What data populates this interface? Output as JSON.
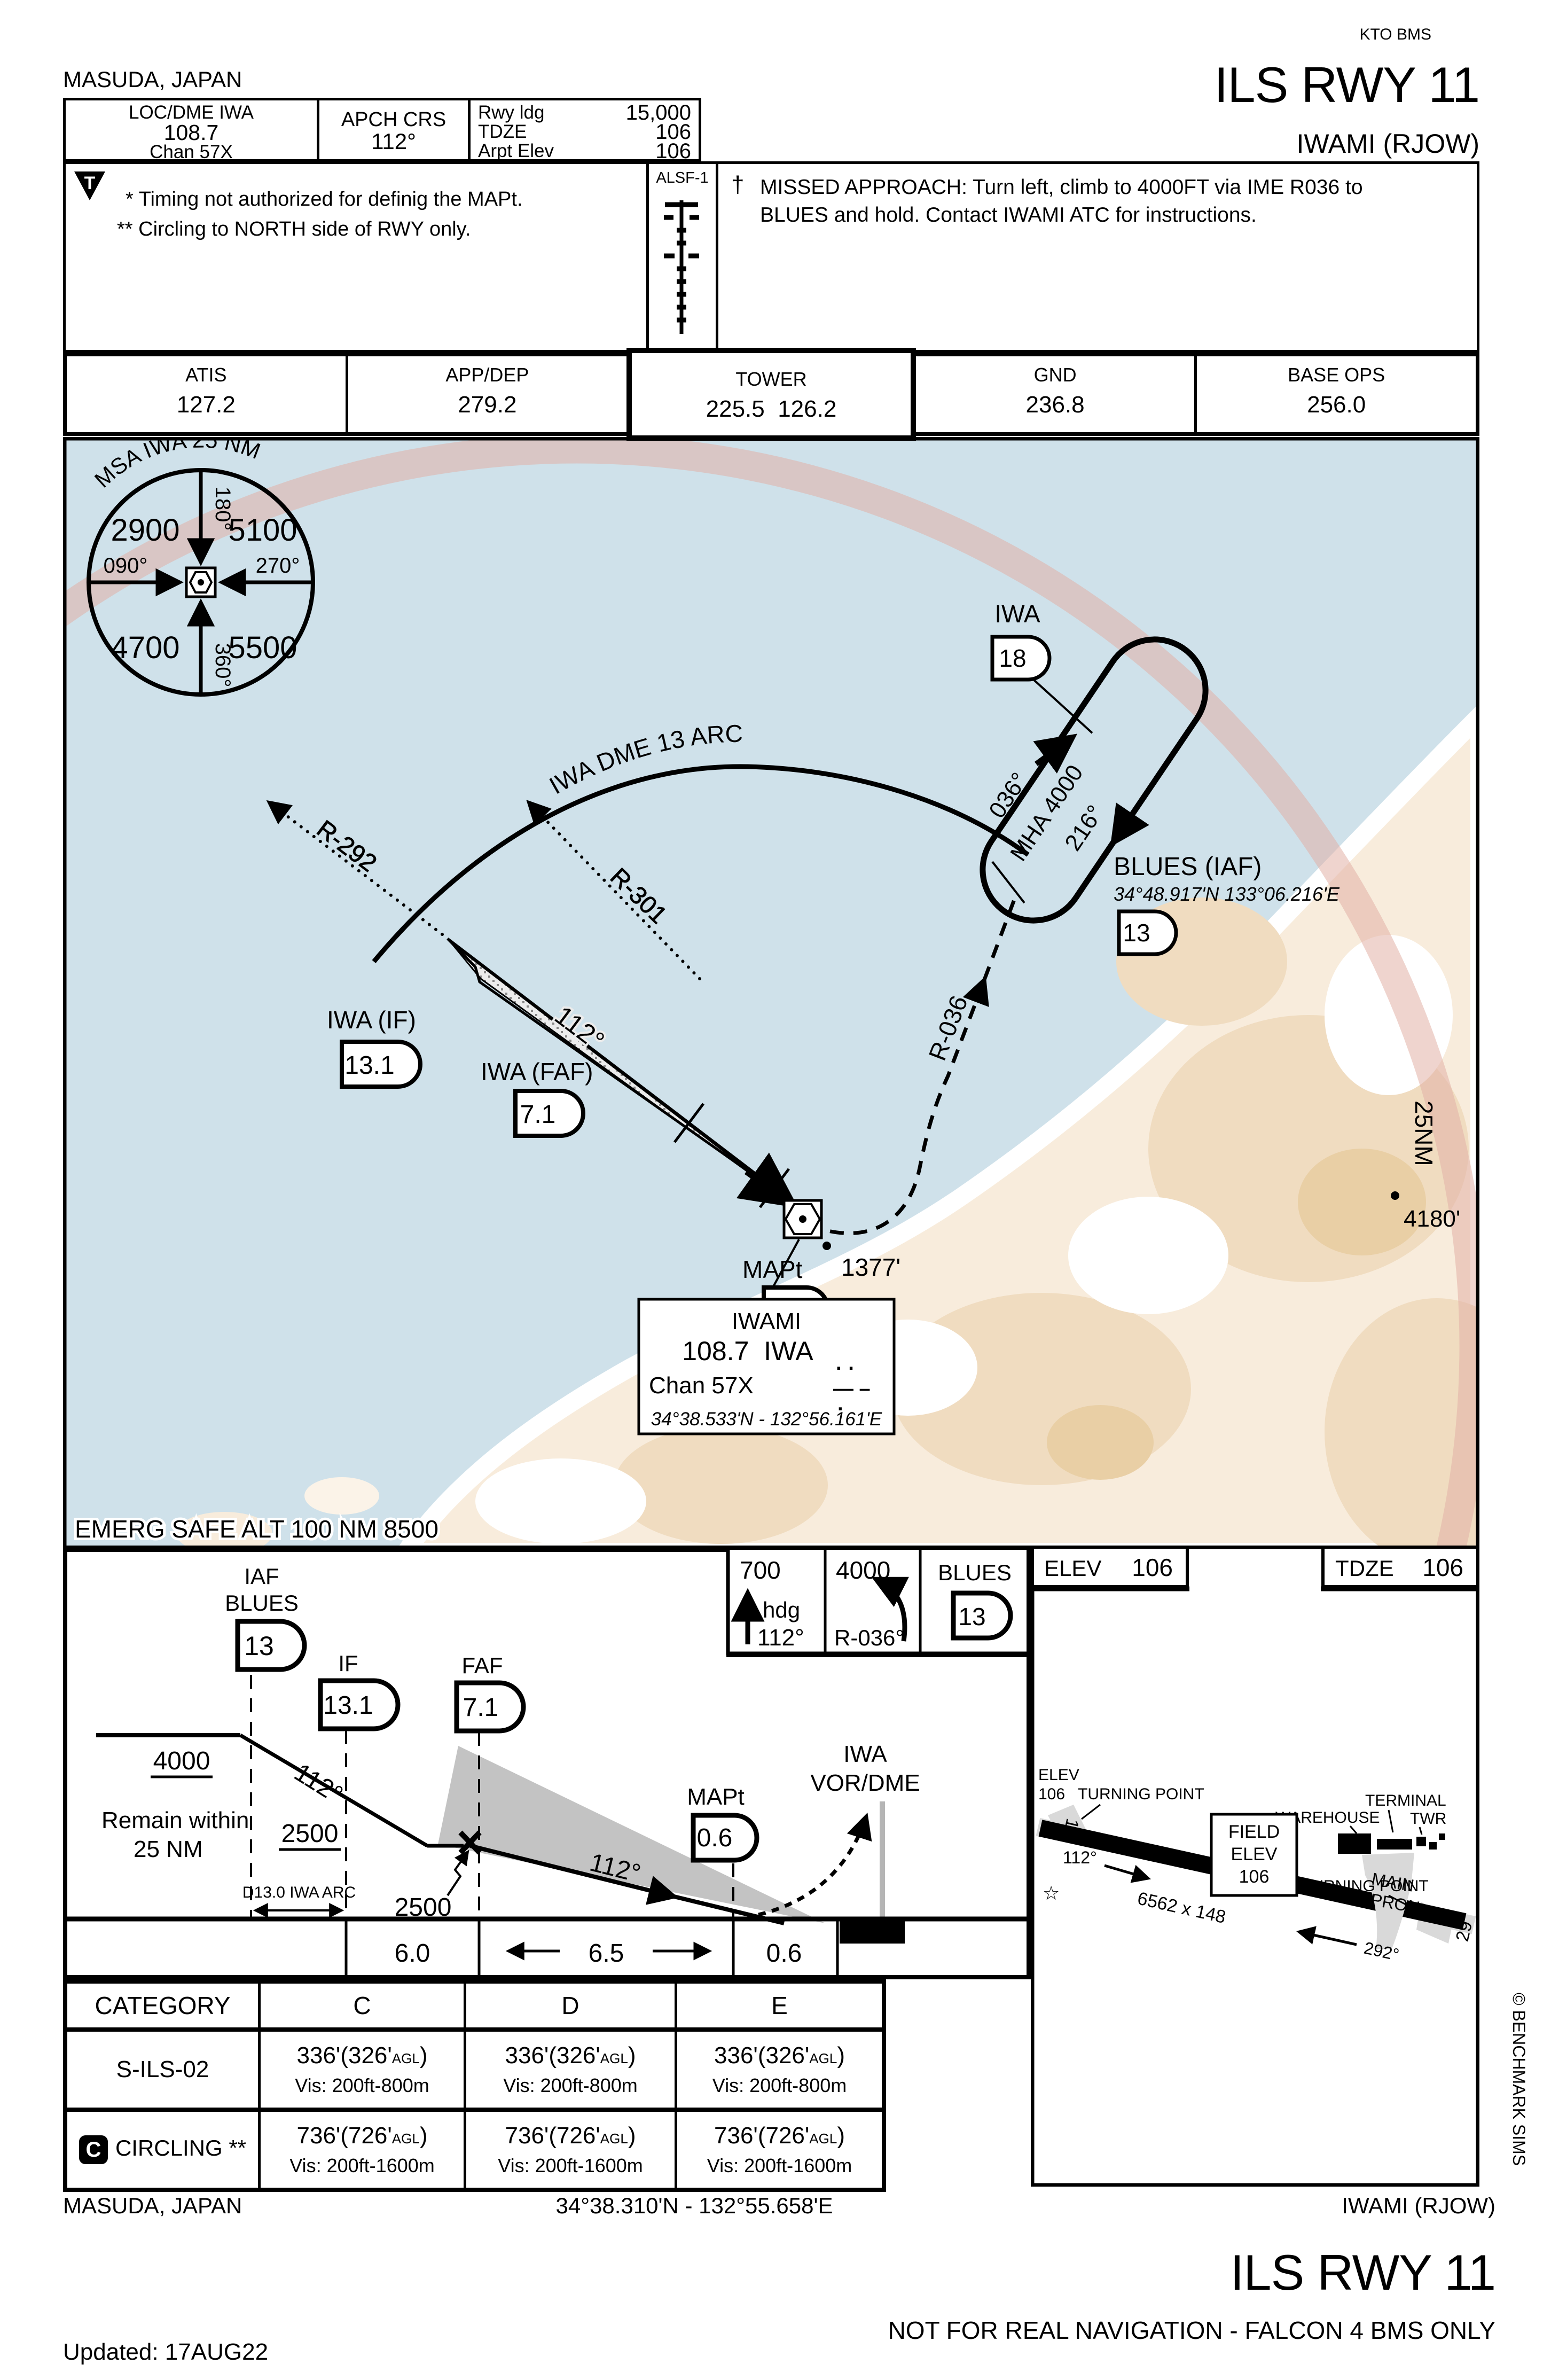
{
  "header": {
    "publisher": "KTO BMS",
    "city": "MASUDA, JAPAN",
    "procedure": "ILS RWY 11",
    "airport": "IWAMI (RJOW)",
    "nav_title": "LOC/DME IWA",
    "nav_freq": "108.7",
    "nav_chan": "Chan 57X",
    "apch_label": "APCH CRS",
    "apch_value": "112°",
    "rwy": [
      {
        "label": "Rwy ldg",
        "value": "15,000"
      },
      {
        "label": "TDZE",
        "value": "106"
      },
      {
        "label": "Arpt Elev",
        "value": "106"
      }
    ],
    "ticon": "T",
    "note1": "* Timing not authorized for definig the MAPt.",
    "note2": "** Circling to NORTH side of RWY only.",
    "alsf": "ALSF-1",
    "dagger": "†",
    "missed_line1": "MISSED APPROACH: Turn left, climb to 4000FT via IME R036 to",
    "missed_line2": "BLUES and hold. Contact IWAMI ATC for instructions."
  },
  "frequencies": [
    {
      "label": "ATIS",
      "value": "127.2"
    },
    {
      "label": "APP/DEP",
      "value": "279.2"
    },
    {
      "label": "TOWER",
      "value": "225.5  126.2"
    },
    {
      "label": "GND",
      "value": "236.8"
    },
    {
      "label": "BASE OPS",
      "value": "256.0"
    }
  ],
  "plan": {
    "msa": {
      "title": "MSA IWA 25 NM",
      "nw": "2900",
      "ne": "5100",
      "sw": "4700",
      "se": "5500",
      "n": "180°",
      "w": "090°",
      "e": "270°",
      "s": "360°"
    },
    "arc_label": "IWA DME 13 ARC",
    "r292": "R-292",
    "r301": "R-301",
    "r036": "R-036",
    "course": "112°",
    "hold_fix": "IWA",
    "hold_dme": "18",
    "hold_in": "036°",
    "hold_mha": "MHA 4000",
    "hold_out": "216°",
    "blues_name": "BLUES (IAF)",
    "blues_coords": "34°48.917'N 133°06.216'E",
    "blues_dme": "13",
    "if_name": "IWA (IF)",
    "if_dme": "13.1",
    "faf_name": "IWA (FAF)",
    "faf_dme": "7.1",
    "mapt_name": "MAPt",
    "mapt_dme": "0.6",
    "spot1": "1377'",
    "spot2": "4180'",
    "ring_label": "25NM",
    "nav_name": "IWAMI",
    "nav_freq": "108.7  IWA",
    "nav_chan": "Chan 57X",
    "nav_coords": "34°38.533'N - 132°56.161'E",
    "morse1": "· ·",
    "morse2": "— –",
    "morse3": "·",
    "emerg": "EMERG SAFE ALT 100 NM 8500"
  },
  "profile": {
    "iaf1": "IAF",
    "iaf2": "BLUES",
    "iaf_dme": "13",
    "if_label": "IF",
    "if_dme": "13.1",
    "faf_label": "FAF",
    "faf_dme": "7.1",
    "mapt_label": "MAPt",
    "mapt_dme": "0.6",
    "alt4000": "4000",
    "alt2500a": "2500",
    "alt2500b": "2500",
    "crs1": "112°",
    "crs2": "112°",
    "remain1": "Remain within",
    "remain2": "25 NM",
    "arc_note": "D13.0 IWA ARC",
    "vor1": "IWA",
    "vor2": "VOR/DME",
    "mb1_alt": "700",
    "mb1_l1": "hdg",
    "mb1_l2": "112°",
    "mb2_alt": "4000",
    "mb2_l1": "R-036°",
    "mb3_fix": "BLUES",
    "mb3_dme": "13",
    "d1": "6.0",
    "d2": "6.5",
    "d3": "0.6"
  },
  "airport": {
    "elev_label": "ELEV",
    "elev_value": "106",
    "tdze_label": "TDZE",
    "tdze_value": "106",
    "elev_s1": "ELEV",
    "elev_s2": "106",
    "tp_left": "TURNING POINT",
    "tp_right": "TURNING POINT",
    "hdg1": "112°",
    "hdg2": "292°",
    "field1": "FIELD",
    "field2": "ELEV",
    "field3": "106",
    "dims": "6562 x 148",
    "warehouse": "WAREHOUSE",
    "terminal": "TERMINAL",
    "twr": "TWR",
    "apron1": "MAIN",
    "apron2": "APRON",
    "rw1": "11",
    "rw2": "29",
    "star": "☆"
  },
  "minimums": {
    "headers": [
      "CATEGORY",
      "C",
      "D",
      "E"
    ],
    "rows": [
      {
        "name": "S-ILS-02",
        "cells": [
          {
            "alt": "336'(326'",
            "agl": "AGL",
            "close": ")",
            "vis": "Vis: 200ft-800m"
          },
          {
            "alt": "336'(326'",
            "agl": "AGL",
            "close": ")",
            "vis": "Vis: 200ft-800m"
          },
          {
            "alt": "336'(326'",
            "agl": "AGL",
            "close": ")",
            "vis": "Vis: 200ft-800m"
          }
        ]
      },
      {
        "name": "CIRCLING **",
        "badge": "C",
        "cells": [
          {
            "alt": "736'(726'",
            "agl": "AGL",
            "close": ")",
            "vis": "Vis: 200ft-1600m"
          },
          {
            "alt": "736'(726'",
            "agl": "AGL",
            "close": ")",
            "vis": "Vis: 200ft-1600m"
          },
          {
            "alt": "736'(726'",
            "agl": "AGL",
            "close": ")",
            "vis": "Vis: 200ft-1600m"
          }
        ]
      }
    ]
  },
  "footer": {
    "city": "MASUDA, JAPAN",
    "coords": "34°38.310'N - 132°55.658'E",
    "airport": "IWAMI (RJOW)",
    "procedure": "ILS RWY 11",
    "disclaimer": "NOT FOR REAL NAVIGATION - FALCON 4 BMS ONLY",
    "updated": "Updated: 17AUG22",
    "copyright": "© BENCHMARK SIMS"
  }
}
